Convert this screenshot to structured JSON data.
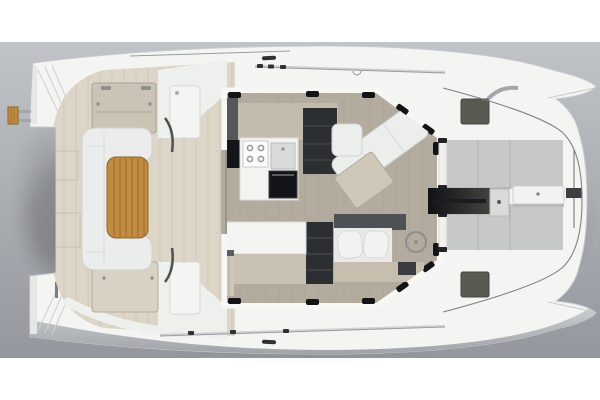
{
  "meta": {
    "title": "Catamaran yacht deck plan - top-down 3D rendering",
    "canvas": {
      "width": 600,
      "height": 400
    }
  },
  "scene": {
    "backdrop": {
      "top": "#c0c3c7",
      "bottom": "#94989e",
      "page_band": "#ffffff"
    },
    "palette": {
      "hull_white": "#f4f5f3",
      "hull_side_shade": "#aeb2b6",
      "deck_beige": "#ddd6c8",
      "panel_beige": "#cbc4b6",
      "panel_beige_light": "#d8d2c5",
      "cockpit_sofa_white": "#ebedec",
      "teak": "#c18c42",
      "teak_stripe": "#a27530",
      "salon_floor": "#b2ab9e",
      "salon_wall_white": "#f7f8f6",
      "frame_black": "#131416",
      "cabinet_dark": "#54575a",
      "appliance_black": "#141518",
      "shelves_dark": "#2c2f31",
      "counter_white": "#f3f3f1",
      "counter_front_beige": "#c9c1b2",
      "sofa_white": "#eceeec",
      "salon_table_beige": "#cfc7b7",
      "nav_back_dark": "#4e5154",
      "nav_desk_beige": "#c7beaf",
      "sunpad_gray": "#c7c9c6",
      "hatch_gray": "#595b53",
      "channel_dark": "#33352f",
      "lid_white": "#f2f3f1",
      "metal_gray": "#8e9296",
      "module_white": "#f4f5f3"
    },
    "regions": [
      {
        "id": "stern-hulls",
        "label": "Twin hull sterns with transom steps"
      },
      {
        "id": "swim-platform",
        "label": "Teak boarding step"
      },
      {
        "id": "aft-cockpit",
        "label": "Aft cockpit with C-shaped sofa and teak table"
      },
      {
        "id": "deck-hatches-aft",
        "label": "Cockpit deck panels"
      },
      {
        "id": "salon",
        "label": "Salon with galley, stove, oven, shelving, L-sofa and nav seat"
      },
      {
        "id": "foredeck",
        "label": "Foredeck with sunpads, anchor channel and deck hatches"
      },
      {
        "id": "bow",
        "label": "Bow fins and anchor fitting"
      }
    ]
  }
}
